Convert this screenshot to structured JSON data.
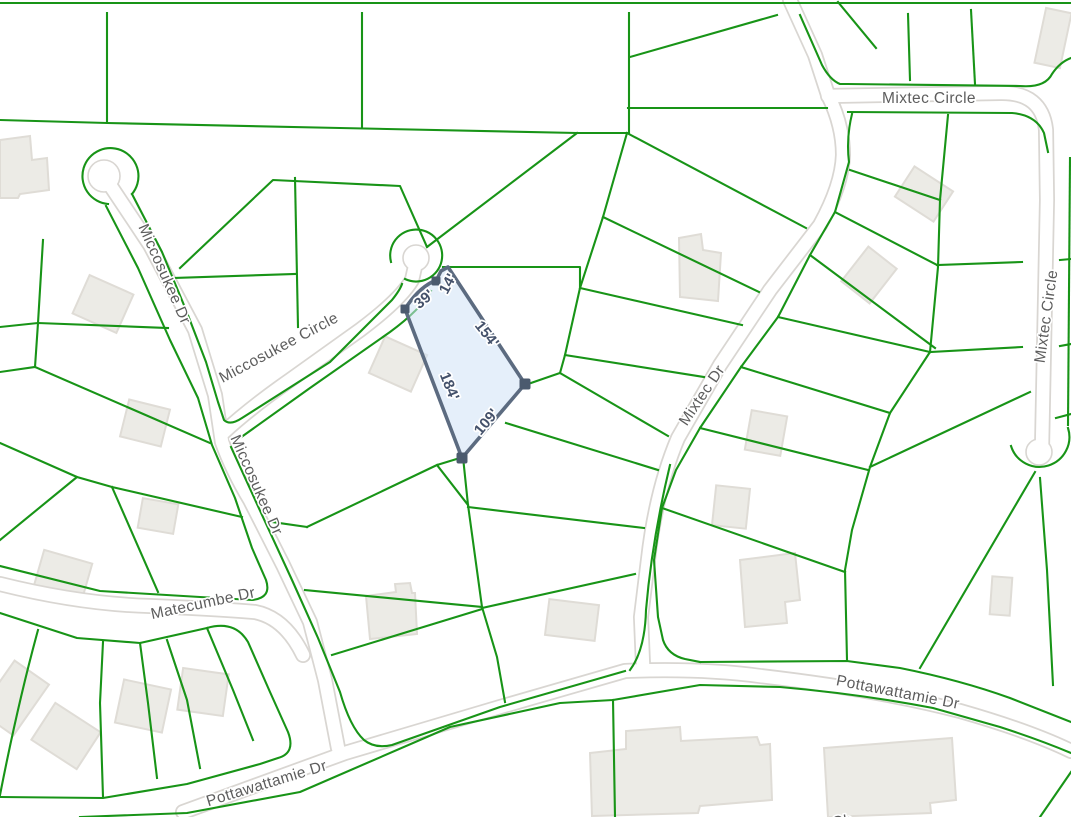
{
  "map": {
    "street_labels": {
      "miccosukee_dr_upper": "Miccosukee Dr",
      "miccosukee_circle": "Miccosukee Circle",
      "miccosukee_dr_lower": "Miccosukee Dr",
      "matecumbe_dr": "Matecumbe Dr",
      "pottawattamie_dr_left": "Pottawattamie Dr",
      "pottawattamie_dr_right": "Pottawattamie Dr",
      "mixtec_dr": "Mixtec Dr",
      "mixtec_circle_top": "Mixtec Circle",
      "mixtec_circle_right": "Mixtec Circle",
      "partial_bottom_edge": "Ch"
    },
    "selected_parcel": {
      "dimensions": {
        "d39": "39'",
        "d14": "14'",
        "d154": "154'",
        "d184": "184'",
        "d109": "109'"
      },
      "vertex_count": 4
    },
    "colors": {
      "bg": "#ffffff",
      "green": "#189417",
      "casing": "#d9d6d2",
      "roadfill": "#ffffff",
      "bldg": "#ecebe6",
      "bldgshadow": "#dfdcd6",
      "streettext": "#5d5d5d",
      "dimtext": "#45526b",
      "parcelfill": "#cfe1f5",
      "parcelstroke": "#5c6b80",
      "vertex": "#4b5a6e"
    }
  }
}
